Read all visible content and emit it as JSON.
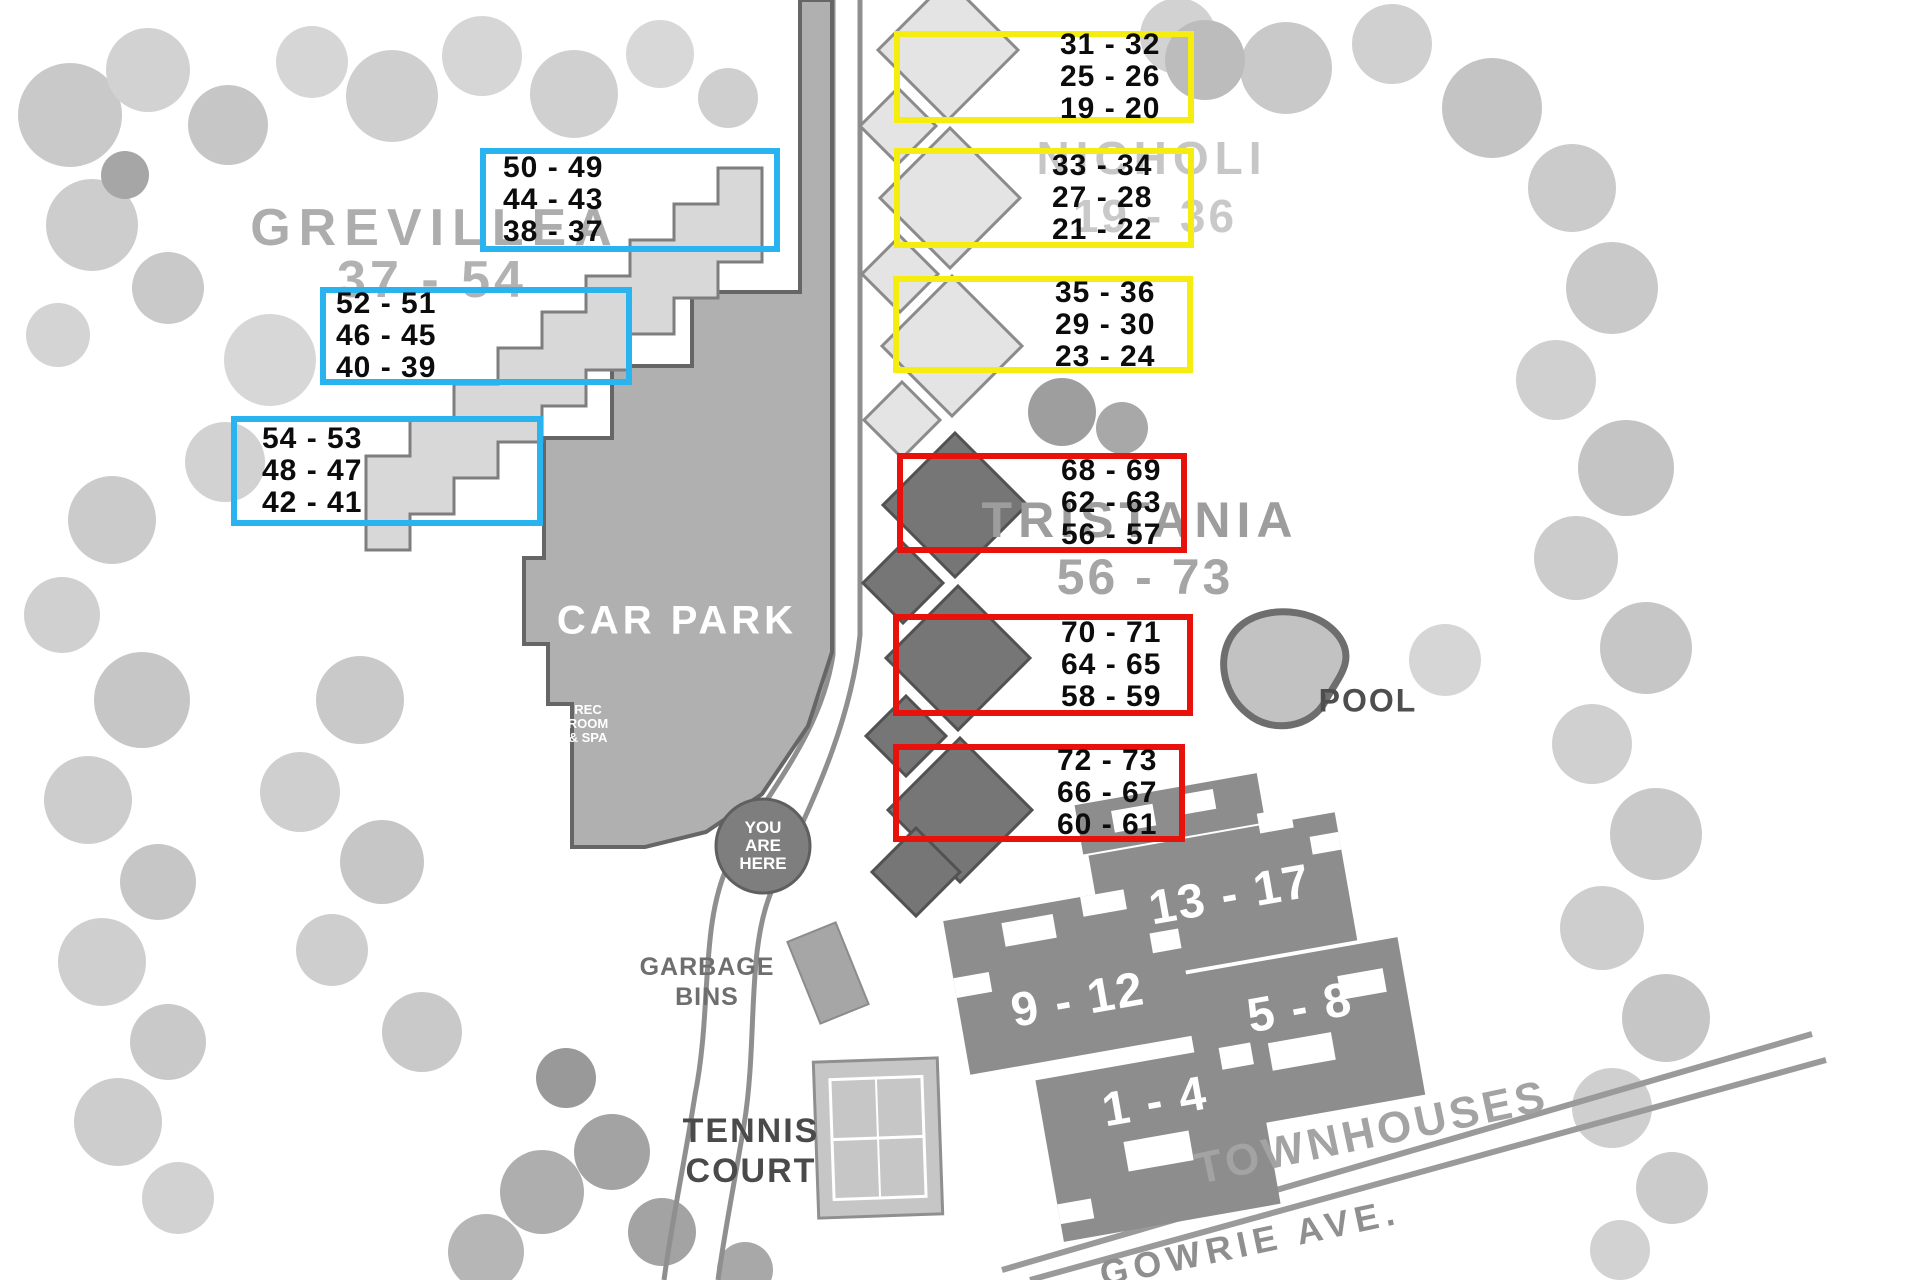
{
  "complexes": [
    {
      "name": "GREVILLEA",
      "range": "37 - 54",
      "accent": "#2ab4ef",
      "boxes": [
        {
          "lines": [
            "50 - 49",
            "44 - 43",
            "38 - 37"
          ]
        },
        {
          "lines": [
            "52 - 51",
            "46 - 45",
            "40 - 39"
          ]
        },
        {
          "lines": [
            "54 - 53",
            "48 - 47",
            "42 - 41"
          ]
        }
      ]
    },
    {
      "name": "NICHOLI",
      "range": "19 - 36",
      "accent": "#f5ec10",
      "boxes": [
        {
          "lines": [
            "31 - 32",
            "25 - 26",
            "19 - 20"
          ]
        },
        {
          "lines": [
            "33 - 34",
            "27 - 28",
            "21 - 22"
          ]
        },
        {
          "lines": [
            "35 - 36",
            "29 - 30",
            "23 - 24"
          ]
        }
      ]
    },
    {
      "name": "TRISTANIA",
      "range": "56 - 73",
      "accent": "#e8120c",
      "boxes": [
        {
          "lines": [
            "68 - 69",
            "62 - 63",
            "56 - 57"
          ]
        },
        {
          "lines": [
            "70 - 71",
            "64 - 65",
            "58 - 59"
          ]
        },
        {
          "lines": [
            "72 - 73",
            "66 - 67",
            "60 - 61"
          ]
        }
      ]
    }
  ],
  "facilities": {
    "car_park": "CAR PARK",
    "rec_room_lines": [
      "REC",
      "ROOM",
      "& SPA"
    ],
    "you_are_here_lines": [
      "YOU",
      "ARE",
      "HERE"
    ],
    "garbage_lines": [
      "GARBAGE",
      "BINS"
    ],
    "tennis_lines": [
      "TENNIS",
      "COURT"
    ],
    "pool": "POOL"
  },
  "townhouses": {
    "label": "TOWNHOUSES",
    "street": "GOWRIE  AVE.",
    "blocks": [
      {
        "label": "13 - 17"
      },
      {
        "label": "9 - 12"
      },
      {
        "label": "5 - 8"
      },
      {
        "label": "1 - 4"
      }
    ]
  }
}
